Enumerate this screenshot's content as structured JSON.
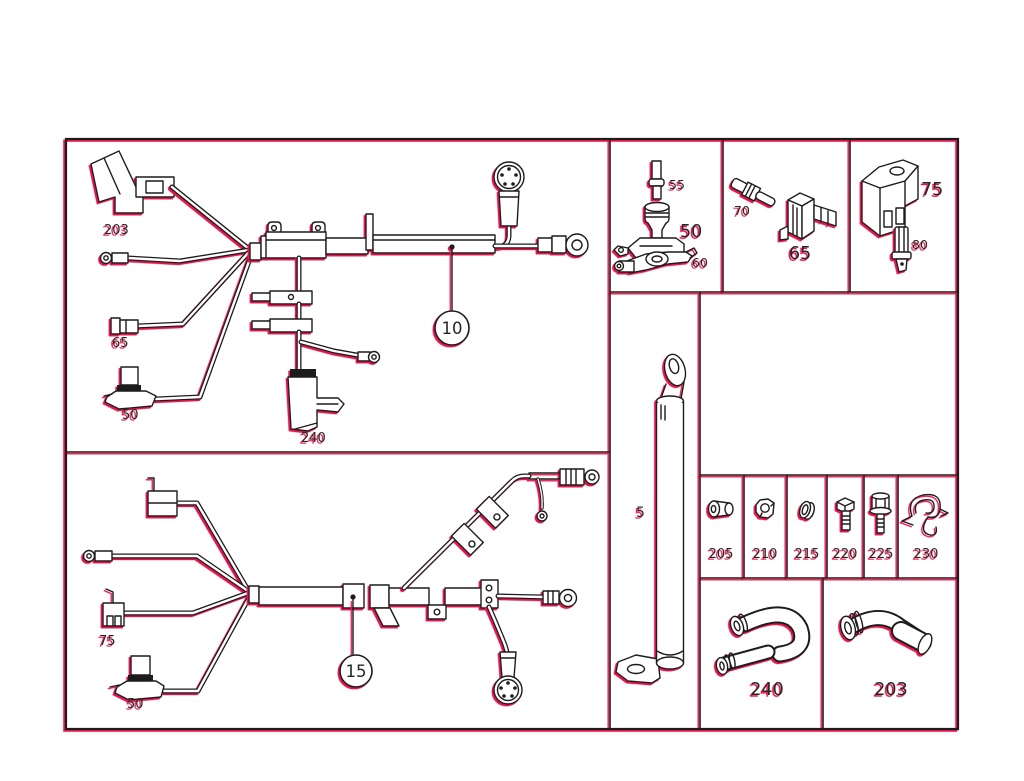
{
  "diagram": {
    "background": "#ffffff",
    "line_color": "#1c1c1c",
    "accent_color": "#e3134e",
    "top_harness": {
      "callout": "10",
      "connector_label": "203",
      "terminal_label": "65",
      "clamp_label": "50",
      "boot_label": "240"
    },
    "bottom_harness": {
      "callout": "15",
      "bracket_label": "75",
      "clamp_label": "50"
    },
    "battery_terminal_panel": {
      "bolt_label": "55",
      "terminal_label": "50",
      "clamp_label": "60"
    },
    "connector_panel": {
      "pin_label": "70",
      "holder_label": "65"
    },
    "bracket_panel": {
      "bracket_label": "75",
      "sensor_label": "80"
    },
    "cable_panel": {
      "cable_label": "5"
    },
    "fastener_row": {
      "cells": [
        "205",
        "210",
        "215",
        "220",
        "225",
        "230"
      ]
    },
    "grommet_cells": {
      "left_label": "240",
      "right_label": "203"
    }
  }
}
